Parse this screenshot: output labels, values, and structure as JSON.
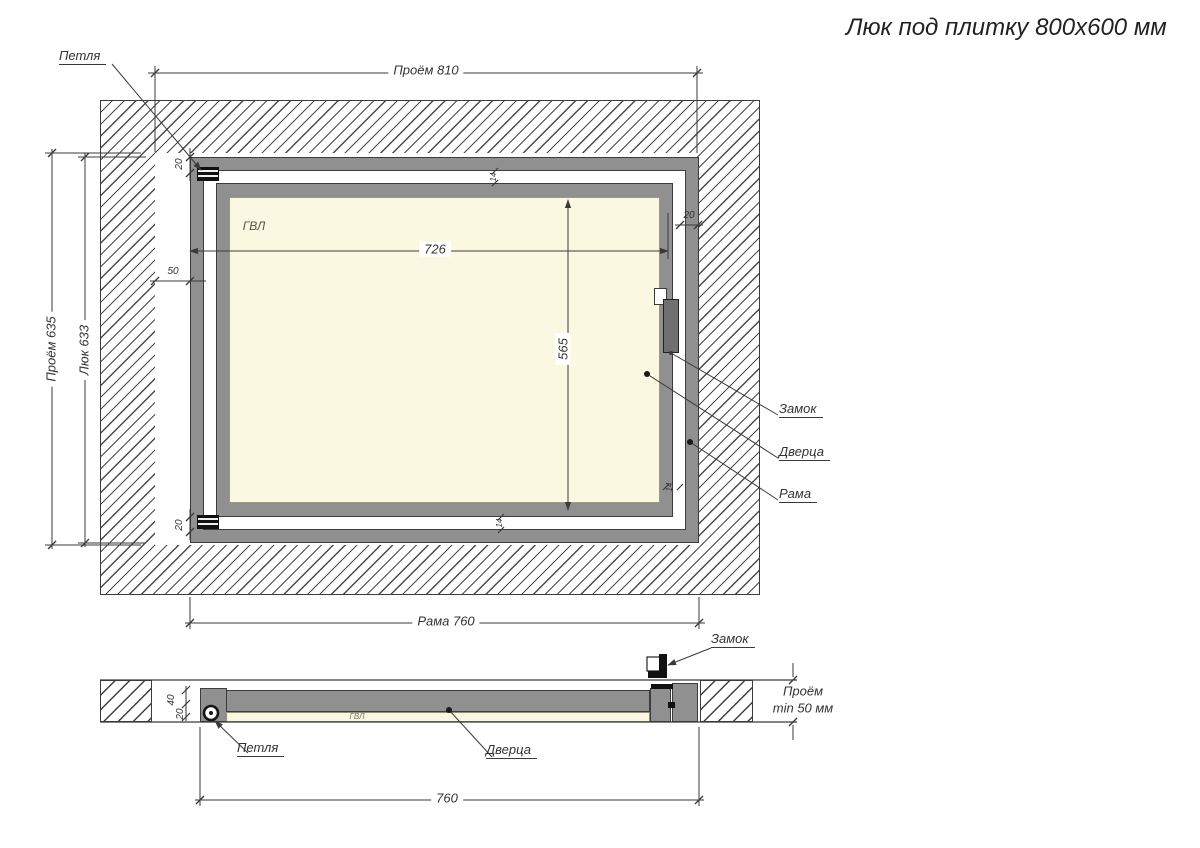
{
  "title": "Люк под плитку 800х600 мм",
  "colors": {
    "line": "#3a3a3a",
    "metal_gray": "#909090",
    "panel_cream": "#faf8e0",
    "hatch": "#4a4a4a"
  },
  "front": {
    "labels": {
      "hinge": "Петля",
      "lock": "Замок",
      "door": "Дверца",
      "frame": "Рама",
      "panel": "ГВЛ"
    },
    "dims": {
      "opening_w": "Проём 810",
      "opening_h": "Проём 635",
      "hatch_h": "Люк 633",
      "gap_left": "50",
      "edge_top_left": "20",
      "edge_bottom_left": "20",
      "edge_top_right": "20",
      "door_w": "726",
      "door_h": "565",
      "gap_top": "14",
      "gap_bottom": "14",
      "gap_right": "14",
      "frame_w": "Рама 760"
    }
  },
  "section": {
    "labels": {
      "hinge": "Петля",
      "lock": "Замок",
      "door": "Дверца",
      "panel": "ГВЛ"
    },
    "dims": {
      "depth40": "40",
      "depth20": "20",
      "opening_l1": "Проём",
      "opening_l2": "min 50 мм",
      "width760": "760"
    }
  }
}
